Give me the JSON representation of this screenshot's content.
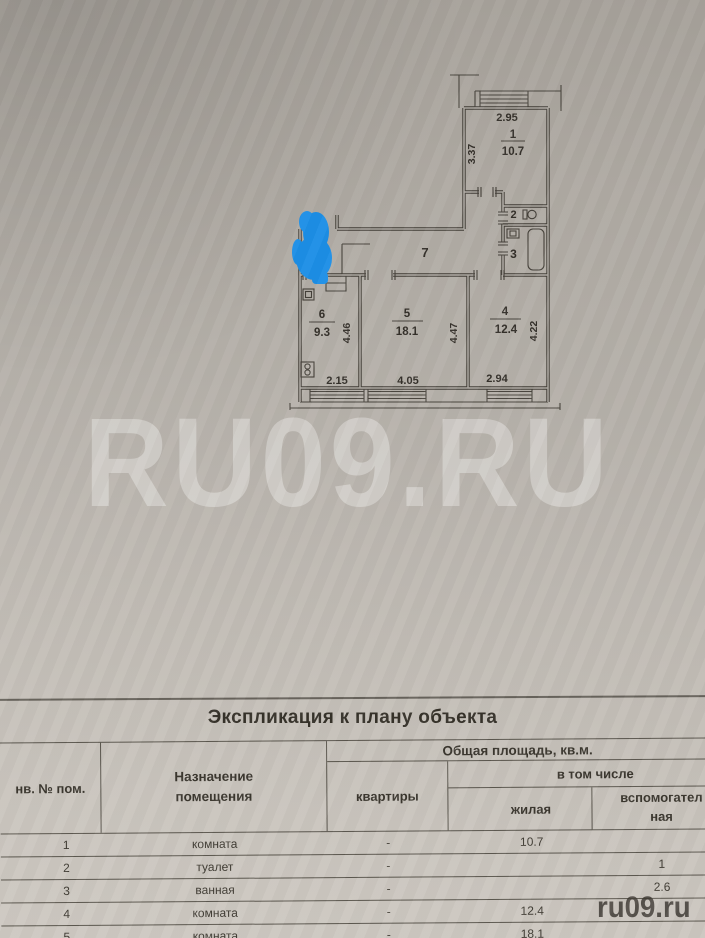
{
  "watermark": {
    "large": "RU09.RU",
    "small": "ru09.ru"
  },
  "plan": {
    "marker_color": "#1d8fe6",
    "labels": {
      "room1_no": "1",
      "room1_area": "10.7",
      "room2_no": "2",
      "room3_no": "3",
      "room4_no": "4",
      "room4_area": "12.4",
      "room5_no": "5",
      "room5_area": "18.1",
      "room6_no": "6",
      "room6_area": "9.3",
      "corridor_no": "7",
      "dim_top": "2.95",
      "dim_room1_h": "3.37",
      "dim_room6_h": "4.46",
      "dim_room5_h": "4.47",
      "dim_room4_h": "4.22",
      "dim_room6_w": "2.15",
      "dim_room5_w": "4.05",
      "dim_room4_w": "2.94"
    }
  },
  "table": {
    "title": "Экспликация к плану объекта",
    "headers": {
      "inv": "нв. № пом.",
      "purpose": "Назначение помещения",
      "total_group": "Общая площадь, кв.м.",
      "flat": "квартиры",
      "including": "в том числе",
      "living": "жилая",
      "aux_line1": "вспомогател",
      "aux_line2": "ная"
    },
    "rows": [
      {
        "num": "1",
        "purpose": "комната",
        "flat": "-",
        "living": "10.7",
        "aux": ""
      },
      {
        "num": "2",
        "purpose": "туалет",
        "flat": "-",
        "living": "",
        "aux": "1"
      },
      {
        "num": "3",
        "purpose": "ванная",
        "flat": "-",
        "living": "",
        "aux": "2.6"
      },
      {
        "num": "4",
        "purpose": "комната",
        "flat": "-",
        "living": "12.4",
        "aux": ""
      },
      {
        "num": "5",
        "purpose": "комната",
        "flat": "-",
        "living": "18.1",
        "aux": ""
      }
    ]
  }
}
